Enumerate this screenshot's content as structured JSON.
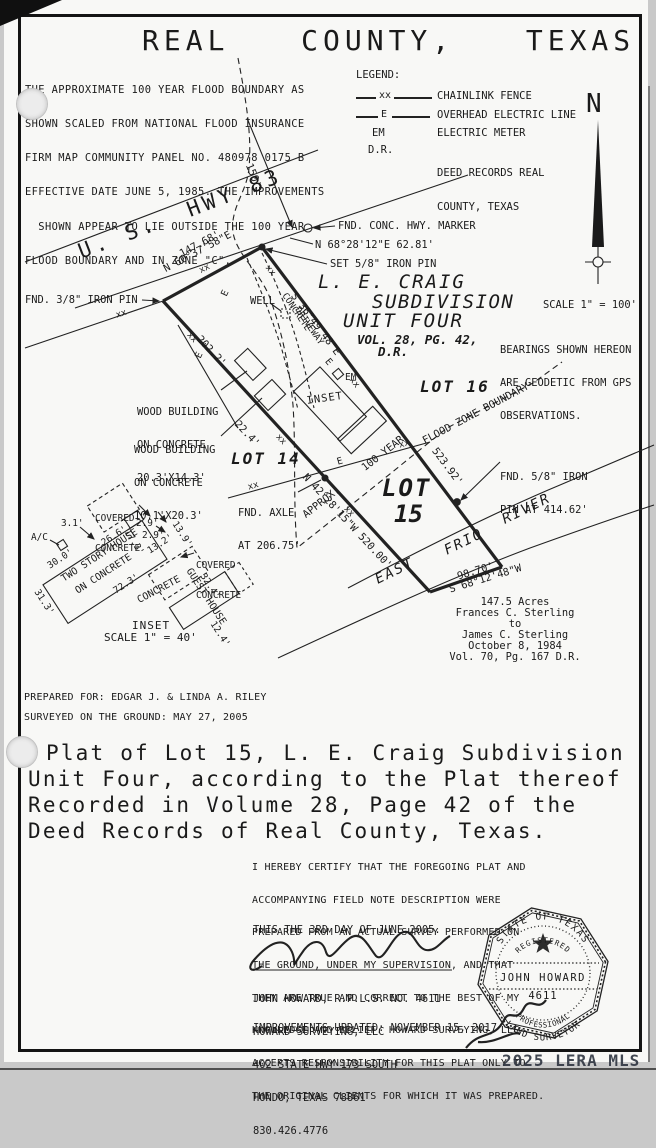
{
  "page": {
    "title": "REAL  COUNTY,  TEXAS",
    "watermark": "2025 LERA MLS"
  },
  "flood_note": {
    "l1": "THE APPROXIMATE 100 YEAR FLOOD BOUNDARY AS",
    "l2": "SHOWN SCALED FROM NATIONAL FLOOD INSURANCE",
    "l3": "FIRM MAP COMMUNITY PANEL NO. 480978 0175 B",
    "l4": "EFFECTIVE DATE JUNE 5, 1985. THE IMPROVEMENTS",
    "l5": "  SHOWN APPEAR TO LIE OUTSIDE THE 100 YEAR",
    "l6": "FLOOD BOUNDARY AND IN ZONE \"C\"."
  },
  "legend": {
    "heading": "LEGEND:",
    "xx": "xx",
    "e": "E",
    "chainlink": "CHAINLINK FENCE",
    "overhead": "OVERHEAD ELECTRIC LINE",
    "em": "EM",
    "electric_meter": "ELECTRIC METER",
    "dr": "D.R.",
    "deed_records1": "DEED RECORDS REAL",
    "deed_records2": "COUNTY, TEXAS"
  },
  "north": {
    "n": "N"
  },
  "plat": {
    "hwy": "U. S.  HWY 83",
    "dim150": "150'",
    "fnd_conc": "FND. CONC. HWY. MARKER",
    "b6828": "N 68°28'12\"E 62.81'",
    "set58": "SET 5/8\" IRON PIN",
    "fnd38": "FND. 3/8\" IRON PIN",
    "d14768": "147.68'",
    "b6037": "N 60°37'58\"E",
    "sub1": "L. E. CRAIG",
    "sub2": "SUBDIVISION",
    "sub3": "UNIT FOUR",
    "vol": "VOL. 28, PG. 42,",
    "dr": "D.R.",
    "scale": "SCALE 1\" = 100'",
    "bn1": "BEARINGS SHOWN HEREON",
    "bn2": "ARE GEODETIC FROM GPS",
    "bn3": "OBSERVATIONS.",
    "lot16": "LOT 16",
    "lot14": "LOT 14",
    "lot15a": "LOT",
    "lot15b": "15",
    "well": "WELL",
    "drive1": "CONCRETE",
    "drive2": "DRIVEWAY",
    "em": "EM",
    "e": "E",
    "xx": "xx",
    "d2022": "202.2'",
    "wb1a": "WOOD BUILDING",
    "wb1b": "ON CONCRETE",
    "wb1c": "20.3'X14.3'",
    "wb2a": "WOOD BUILDING",
    "wb2b": "ON CONCRETE",
    "wb2c": "10.1'X20.3'",
    "d224": "22.4'",
    "axle1": "FND. AXLE",
    "axle2": "AT 206.75'",
    "b4228": "N 42°28'15\"W 520.00'",
    "approx": "APPROX.",
    "yr100": "100 YEAR",
    "fzb": "FLOOD ZONE BOUNDARY",
    "b3649": "S 36°49'48\"E",
    "d52392": "523.92'",
    "fnd58a": "FND. 5/8\" IRON",
    "fnd58b": "PIN AT 414.62'",
    "east": "EAST",
    "frio": "FRIO",
    "river": "RIVER",
    "d9870": "98.70'",
    "b6812": "S 68°12'48\"W",
    "deed1": "147.5 Acres",
    "deed2": "Frances C. Sterling",
    "deed3": "to",
    "deed4": "James C. Sterling",
    "deed5": "October 8, 1984",
    "deed6": "Vol. 70, Pg. 167 D.R.",
    "inset_lbl": "INSET"
  },
  "inset": {
    "cc1": "COVERED",
    "cc2": "CONCRETE",
    "d31": "3.1'",
    "ac": "A/C",
    "d29a": "2.9'",
    "d29b": "2.9'",
    "d139": "13.9'",
    "d173": "17.3'",
    "d132": "13.2'",
    "d266": "26.6'",
    "d300": "30.0'",
    "d313": "31.3'",
    "tsh1": "TWO STORY HOUSE",
    "tsh2": "ON CONCRETE",
    "d723": "72.3'",
    "conc": "CONCRETE",
    "gh": "GUEST HOUSE",
    "d324": "32.4'",
    "d124": "12.4'",
    "inset_t": "INSET",
    "inset_s": "SCALE 1\" = 40'"
  },
  "footer": {
    "prepared_for": "PREPARED FOR: EDGAR J. & LINDA A. RILEY",
    "surveyed": "SURVEYED ON THE GROUND: MAY 27, 2005",
    "title1": "Plat of Lot 15, L. E. Craig Subdivision",
    "title2": "Unit Four, according to the Plat thereof",
    "title3": "Recorded in Volume 28, Page 42 of the",
    "title4": "Deed Records of Real County, Texas."
  },
  "certification": {
    "l1": "I HEREBY CERTIFY THAT THE FOREGOING PLAT AND",
    "l2": "ACCOMPANYING FIELD NOTE DESCRIPTION WERE",
    "l3": "PREPARED FROM AN ACTUAL SURVEY PERFORMED ON",
    "l4": "THE GROUND, UNDER MY SUPERVISION, AND THAT",
    "l5": "THEY ARE TRUE AND CORRECT TO THE BEST OF MY",
    "l6": "KNOWLEDGE AND BELIEF. HOWARD SURVEYING, LLC",
    "l7": "ACCEPTS RESPONSIBILITY FOR THIS PLAT ONLY TO",
    "l8": "THE ORIGINAL CLIENTS FOR WHICH IT WAS PREPARED.",
    "date": "THIS THE 3RD DAY OF JUNE 2005."
  },
  "surveyor": {
    "name": "JOHN HOWARD, R.P.L.S. NO. 4611",
    "company": "HOWARD SURVEYING, LLC",
    "address1": "402 STATE HWY 173 SOUTH",
    "address2": "HONDO, TEXAS 78861",
    "phone": "830.426.4776",
    "improvements": "IMPROVEMENTS UPDATED: NOVEMBER 15, 2017"
  },
  "seal": {
    "state": "STATE OF TEXAS",
    "registered": "REGISTERED",
    "name": "JOHN HOWARD",
    "number": "4611",
    "prof": "PROFESSIONAL",
    "land": "LAND SURVEYOR"
  }
}
